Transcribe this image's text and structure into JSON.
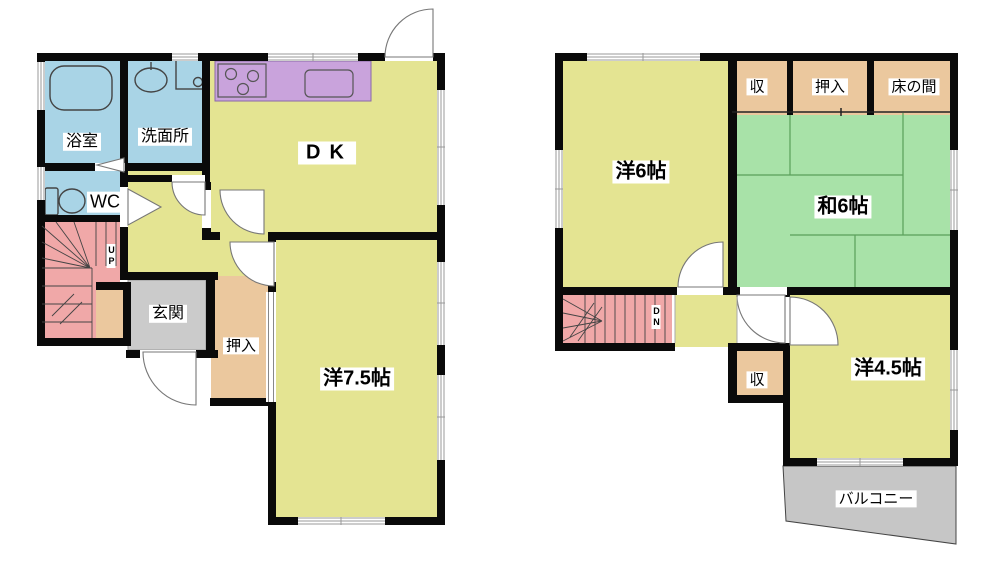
{
  "first_floor": {
    "rooms": {
      "bathroom": "浴室",
      "washroom": "洗面所",
      "dining_kitchen": "DK",
      "toilet": "WC",
      "stairs": "UP",
      "entrance": "玄関",
      "closet": "押入",
      "western_room": "洋7.5帖"
    }
  },
  "second_floor": {
    "rooms": {
      "western_room_6": "洋6帖",
      "storage_top": "収",
      "closet": "押入",
      "alcove": "床の間",
      "japanese_room": "和6帖",
      "stairs": "DN",
      "storage_bottom": "収",
      "western_room_45": "洋4.5帖",
      "balcony": "バルコニー"
    }
  },
  "colors": {
    "room_yellow": "#e4e492",
    "water_blue": "#a9d4e6",
    "kitchen_purple": "#c9a3dc",
    "stairs_pink": "#f0a8a8",
    "closet_tan": "#ebc89e",
    "tatami_green": "#a8e2a8",
    "entrance_gray": "#cbcbcb",
    "wall_black": "#0a0a0a"
  }
}
